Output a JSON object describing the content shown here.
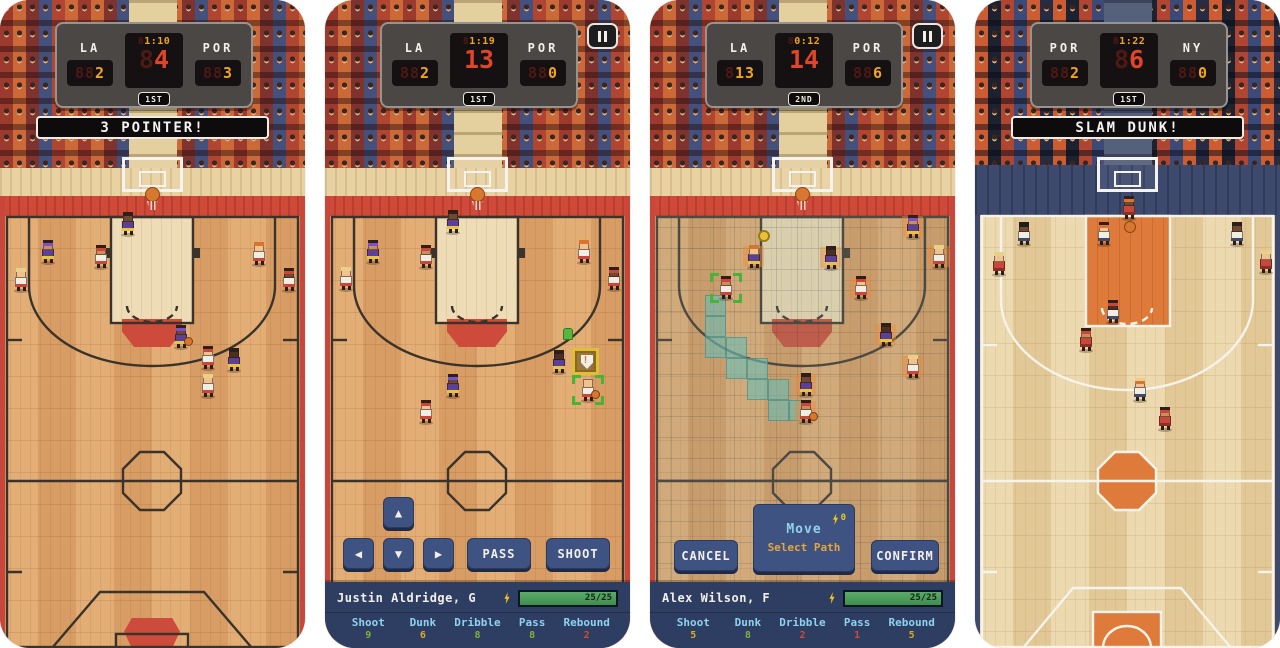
{
  "icons": {
    "dpad_up": "▲",
    "dpad_down": "▼",
    "dpad_left": "◀",
    "dpad_right": "▶",
    "pause": "pause-bars-icon",
    "stamina_bolt": "lightning-bolt-icon",
    "shield": "shield-exclaim-icon",
    "shield_mark": "!",
    "ball": "basketball-icon",
    "ball_marker": "ball-target-icon",
    "pickup": "pickup-icon"
  },
  "colors": {
    "accent_yellow": "#f0a51e",
    "accent_red": "#e04527",
    "banner_bg": "#0d0b0c",
    "button_blue": "#3e5382",
    "bar_navy": "#2e3d62",
    "stamina_green": "#4a9e5c",
    "court_red": "#cf4a39",
    "court_orange": "#de7b3b",
    "tones": {
      "green": "#7db23c",
      "yellow": "#d9a92c",
      "red": "#cf4c2e"
    },
    "jerseys": {
      "la": "#5d3f96",
      "por": "#f2ede2",
      "red": "#c8473a",
      "ny": "#f2ede2"
    },
    "shorts": {
      "la": "#e8c43c",
      "por": "#c8473a",
      "red": "#8a2f28",
      "ny": "#3d4a6e"
    },
    "skins": {
      "light": "#f0c290",
      "tan": "#c98e5a",
      "dark": "#6e4a32",
      "vdark": "#4a3022"
    },
    "hairs": {
      "dark": "#2e2018",
      "blond": "#e8d08a",
      "orange": "#d87430",
      "bald": "#f0c290"
    },
    "bands": {
      "purple": "#7a4fd0",
      "red": "#c8473a",
      "orange": "#d87430",
      "black": "#1e1e1e"
    }
  },
  "panels": [
    {
      "scoreboard": {
        "home_team": "LA",
        "home_score": "2",
        "away_team": "POR",
        "away_score": "3",
        "clock": "1:10",
        "shot_clock": "4",
        "period": "1ST"
      },
      "banner": "3 POINTER!",
      "players": [
        {
          "x": 120,
          "y": 212,
          "team": "la",
          "skin": "dark",
          "hair": "dark"
        },
        {
          "x": 40,
          "y": 240,
          "team": "la",
          "skin": "tan",
          "hair": "dark",
          "band": "purple"
        },
        {
          "x": 93,
          "y": 245,
          "team": "por",
          "skin": "tan",
          "hair": "dark",
          "band": "red"
        },
        {
          "x": 251,
          "y": 242,
          "team": "por",
          "skin": "light",
          "hair": "orange"
        },
        {
          "x": 281,
          "y": 268,
          "team": "por",
          "skin": "dark",
          "hair": "dark",
          "band": "red"
        },
        {
          "x": 13,
          "y": 268,
          "team": "por",
          "skin": "light",
          "hair": "blond"
        },
        {
          "x": 173,
          "y": 325,
          "team": "la",
          "skin": "dark",
          "hair": "dark",
          "band": "purple",
          "ball": true
        },
        {
          "x": 200,
          "y": 346,
          "team": "por",
          "skin": "light",
          "hair": "dark",
          "band": "red"
        },
        {
          "x": 226,
          "y": 348,
          "team": "la",
          "skin": "vdark",
          "hair": "dark"
        },
        {
          "x": 200,
          "y": 374,
          "team": "por",
          "skin": "light",
          "hair": "blond"
        }
      ],
      "fx": []
    },
    {
      "scoreboard": {
        "home_team": "LA",
        "home_score": "2",
        "away_team": "POR",
        "away_score": "0",
        "clock": "1:19",
        "shot_clock": "13",
        "period": "1ST"
      },
      "controls": {
        "pass_label": "PASS",
        "shoot_label": "SHOOT"
      },
      "player_bar": {
        "name": "Justin Aldridge, G",
        "stamina": "25/25",
        "stats": [
          {
            "label": "Shoot",
            "value": "9",
            "tone": "green"
          },
          {
            "label": "Dunk",
            "value": "6",
            "tone": "yellow"
          },
          {
            "label": "Dribble",
            "value": "8",
            "tone": "green"
          },
          {
            "label": "Pass",
            "value": "8",
            "tone": "green"
          },
          {
            "label": "Rebound",
            "value": "2",
            "tone": "red"
          }
        ]
      },
      "players": [
        {
          "x": 120,
          "y": 210,
          "team": "la",
          "skin": "dark",
          "hair": "dark"
        },
        {
          "x": 40,
          "y": 240,
          "team": "la",
          "skin": "tan",
          "hair": "dark",
          "band": "purple"
        },
        {
          "x": 93,
          "y": 245,
          "team": "por",
          "skin": "tan",
          "hair": "dark",
          "band": "red"
        },
        {
          "x": 251,
          "y": 240,
          "team": "por",
          "skin": "light",
          "hair": "orange"
        },
        {
          "x": 281,
          "y": 267,
          "team": "por",
          "skin": "dark",
          "hair": "dark",
          "band": "red"
        },
        {
          "x": 13,
          "y": 267,
          "team": "por",
          "skin": "light",
          "hair": "blond"
        },
        {
          "x": 226,
          "y": 350,
          "team": "la",
          "skin": "vdark",
          "hair": "dark"
        },
        {
          "x": 120,
          "y": 374,
          "team": "la",
          "skin": "dark",
          "hair": "dark",
          "band": "purple"
        },
        {
          "x": 93,
          "y": 400,
          "team": "por",
          "skin": "light",
          "hair": "dark",
          "band": "red"
        },
        {
          "x": 255,
          "y": 378,
          "team": "por",
          "skin": "light",
          "hair": "bald",
          "ball": true,
          "selected": true
        }
      ],
      "fx": [
        {
          "type": "shield",
          "x": 247,
          "y": 348
        },
        {
          "type": "pickup",
          "x": 238,
          "y": 328
        }
      ]
    },
    {
      "scoreboard": {
        "home_team": "LA",
        "home_score": "13",
        "away_team": "POR",
        "away_score": "6",
        "clock": "0:12",
        "shot_clock": "14",
        "period": "2ND"
      },
      "move_overlay": {
        "title": "Move",
        "cost": "0",
        "subtitle": "Select Path",
        "cancel_label": "CANCEL",
        "confirm_label": "CONFIRM"
      },
      "player_bar": {
        "name": "Alex Wilson, F",
        "stamina": "25/25",
        "stats": [
          {
            "label": "Shoot",
            "value": "5",
            "tone": "yellow"
          },
          {
            "label": "Dunk",
            "value": "8",
            "tone": "green"
          },
          {
            "label": "Dribble",
            "value": "2",
            "tone": "red"
          },
          {
            "label": "Pass",
            "value": "1",
            "tone": "red"
          },
          {
            "label": "Rebound",
            "value": "5",
            "tone": "yellow"
          }
        ]
      },
      "path_tiles": [
        [
          55,
          295
        ],
        [
          55,
          316
        ],
        [
          55,
          337
        ],
        [
          76,
          337
        ],
        [
          76,
          358
        ],
        [
          97,
          358
        ],
        [
          97,
          379
        ],
        [
          118,
          379
        ],
        [
          118,
          400
        ],
        [
          139,
          400
        ]
      ],
      "players": [
        {
          "x": 255,
          "y": 215,
          "team": "la",
          "skin": "tan",
          "hair": "dark",
          "band": "purple",
          "tile": true
        },
        {
          "x": 281,
          "y": 245,
          "team": "por",
          "skin": "light",
          "hair": "blond",
          "tile": true
        },
        {
          "x": 96,
          "y": 245,
          "team": "la",
          "skin": "light",
          "hair": "orange",
          "tile": true
        },
        {
          "x": 173,
          "y": 246,
          "team": "la",
          "skin": "vdark",
          "hair": "dark",
          "tile": true
        },
        {
          "x": 68,
          "y": 276,
          "team": "por",
          "skin": "tan",
          "hair": "dark",
          "band": "red",
          "selected": true
        },
        {
          "x": 203,
          "y": 276,
          "team": "por",
          "skin": "light",
          "hair": "dark",
          "band": "red",
          "tile": true
        },
        {
          "x": 228,
          "y": 323,
          "team": "la",
          "skin": "vdark",
          "hair": "dark",
          "tile": true
        },
        {
          "x": 255,
          "y": 355,
          "team": "por",
          "skin": "light",
          "hair": "blond",
          "tile": true
        },
        {
          "x": 148,
          "y": 373,
          "team": "la",
          "skin": "dark",
          "hair": "dark",
          "tile": true
        },
        {
          "x": 148,
          "y": 400,
          "team": "por",
          "skin": "tan",
          "hair": "dark",
          "band": "red",
          "ball": true,
          "tile": true
        }
      ],
      "fx": [
        {
          "type": "ball_marker",
          "x": 108,
          "y": 230
        }
      ]
    },
    {
      "scoreboard": {
        "home_team": "POR",
        "home_score": "2",
        "away_team": "NY",
        "away_score": "0",
        "clock": "1:22",
        "shot_clock": "6",
        "period": "1ST"
      },
      "banner": "SLAM DUNK!",
      "players": [
        {
          "x": 146,
          "y": 196,
          "team": "red",
          "skin": "dark",
          "hair": "dark",
          "band": "orange"
        },
        {
          "x": 41,
          "y": 222,
          "team": "ny",
          "skin": "dark",
          "hair": "black_cap"
        },
        {
          "x": 121,
          "y": 222,
          "team": "ny",
          "skin": "light",
          "hair": "dark",
          "band": "orange"
        },
        {
          "x": 254,
          "y": 222,
          "team": "ny",
          "skin": "dark",
          "hair": "dark"
        },
        {
          "x": 16,
          "y": 252,
          "team": "red",
          "skin": "light",
          "hair": "blond"
        },
        {
          "x": 283,
          "y": 250,
          "team": "red",
          "skin": "light",
          "hair": "blond"
        },
        {
          "x": 130,
          "y": 300,
          "team": "ny",
          "skin": "vdark",
          "hair": "dark",
          "band": "red"
        },
        {
          "x": 103,
          "y": 328,
          "team": "red",
          "skin": "tan",
          "hair": "dark",
          "band": "red"
        },
        {
          "x": 157,
          "y": 378,
          "team": "ny",
          "skin": "light",
          "hair": "blond",
          "band": "orange"
        },
        {
          "x": 182,
          "y": 407,
          "team": "red",
          "skin": "tan",
          "hair": "dark",
          "band": "red"
        }
      ],
      "fx": [
        {
          "type": "ball",
          "x": 149,
          "y": 221
        }
      ]
    }
  ]
}
